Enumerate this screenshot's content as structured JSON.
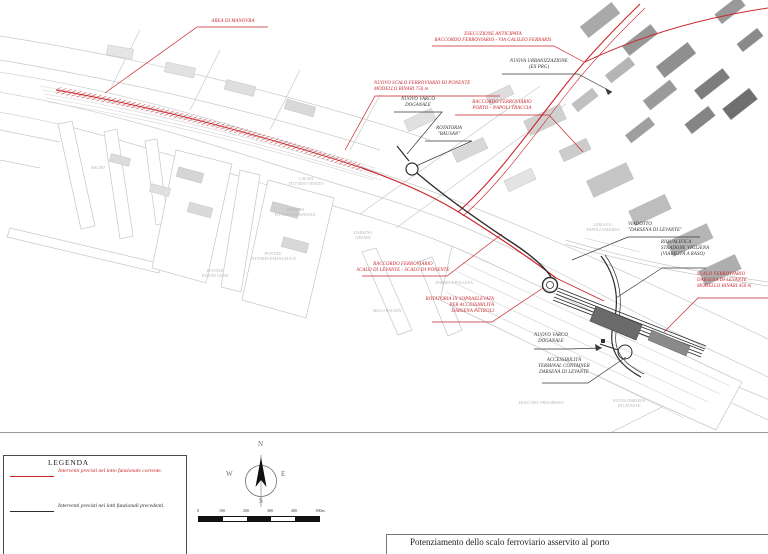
{
  "title_block": {
    "title": "Potenziamento dello scalo ferroviario asservito al porto"
  },
  "legend": {
    "title": "LEGENDA",
    "items": [
      {
        "label": "Interventi previsti nel lotto funzionale corrente.",
        "color": "#c9252b"
      },
      {
        "label": "Interventi previsti nei lotti funzionali precedenti.",
        "color": "#2e2e2e"
      }
    ]
  },
  "compass": {
    "north": "N",
    "east": "E",
    "south": "S",
    "west": "W"
  },
  "scale_bar": {
    "ticks": [
      "0",
      "100",
      "200",
      "300",
      "400",
      "500m"
    ]
  },
  "map": {
    "annotations": [
      {
        "id": "area-di-manovra",
        "color": "#c9252b",
        "text": "AREA DI MANOVRA"
      },
      {
        "id": "esecuzione-anticipata",
        "color": "#c9252b",
        "text": "ESECUZIONE ANTICIPATA\nRACCORDO FERROVIARIO - VIA GALILEO FERRARIS"
      },
      {
        "id": "nuova-urbanizzazione",
        "color": "#2e2e2e",
        "text": "NUOVA URBANIZZAZIONE\n(EX PRG)"
      },
      {
        "id": "scalo-ponente",
        "color": "#c9252b",
        "text": "NUOVO SCALO FERROVIARIO DI PONENTE\nMODELLO BINARI 750 m"
      },
      {
        "id": "raccordo-traccia",
        "color": "#c9252b",
        "text": "RACCORDO FERROVIARIO\nPORTO - NAPOLI TRACCIA"
      },
      {
        "id": "varco-doganale-ovest",
        "color": "#2e2e2e",
        "text": "NUOVO VARCO\nDOGANALE"
      },
      {
        "id": "rotatoria-bausan",
        "color": "#2e2e2e",
        "text": "ROTATORIA\n\"BAUSAN\""
      },
      {
        "id": "viadotto-levante",
        "color": "#2e2e2e",
        "text": "VIADOTTO\n\"DARSENA DI LEVANTE\""
      },
      {
        "id": "riqualifica-vigliena",
        "color": "#2e2e2e",
        "text": "RIQUALIFICA\nSTRADONE VIGLIENA\n(VIABILITÀ A RASO)"
      },
      {
        "id": "scalo-levante",
        "color": "#c9252b",
        "text": "SCALO FERROVIARIO\nDARSENA DI LEVANTE\nMODELLO BINARI 450 m"
      },
      {
        "id": "raccordo-levante-ponente",
        "color": "#c9252b",
        "text": "RACCORDO FERROVIARIO\nSCALO DI LEVANTE - SCALO DI PONENTE"
      },
      {
        "id": "rotatoria-sopraelevata",
        "color": "#c9252b",
        "text": "ROTATORIA IN SOPRAELEVATA\nPER ACCESSIBILITÀ\nDARSENA PETROLI"
      },
      {
        "id": "varco-doganale-est",
        "color": "#2e2e2e",
        "text": "NUOVO VARCO\nDOGANALE"
      },
      {
        "id": "accessibilita-terminal",
        "color": "#2e2e2e",
        "text": "ACCESSIBILITÀ\nTERMINAL CONTAINER\nDARSENA DI LEVANTE"
      }
    ],
    "area_labels": [
      {
        "id": "linea-fs",
        "text": "LINEA F.S.\nNAPOLI-SALERNO"
      },
      {
        "id": "calata-vittorio-veneto",
        "text": "CALATA\nVITTORIO VENETO"
      },
      {
        "id": "darsena-vittorio-emanuele",
        "text": "DARSENA\nVITTORIO EMANUELE"
      },
      {
        "id": "darsena-grandi",
        "text": "DARSENA\nGRANDI"
      },
      {
        "id": "pontile-vittorio-emanuele",
        "text": "PONTILE\nVITTORIO EMANUELE II"
      },
      {
        "id": "pontile-flavio-gioia",
        "text": "PONTILE\nFLAVIO GIOIA"
      },
      {
        "id": "bacini",
        "text": "BACINI"
      },
      {
        "id": "molo-bausan",
        "text": "MOLO BAUSAN"
      },
      {
        "id": "darsena-pollena",
        "text": "DARSENA POLLENA"
      },
      {
        "id": "molo-del-progresso",
        "text": "MOLO DEL PROGRESSO"
      },
      {
        "id": "nuova-darsena-di-levante",
        "text": "NUOVA DARSENA\nDI LEVANTE"
      }
    ]
  },
  "colors": {
    "intervention_current": "#c9252b",
    "intervention_previous": "#2e2e2e",
    "base_linework": "#c9c9c9",
    "faint_label": "#b5b5b5"
  }
}
